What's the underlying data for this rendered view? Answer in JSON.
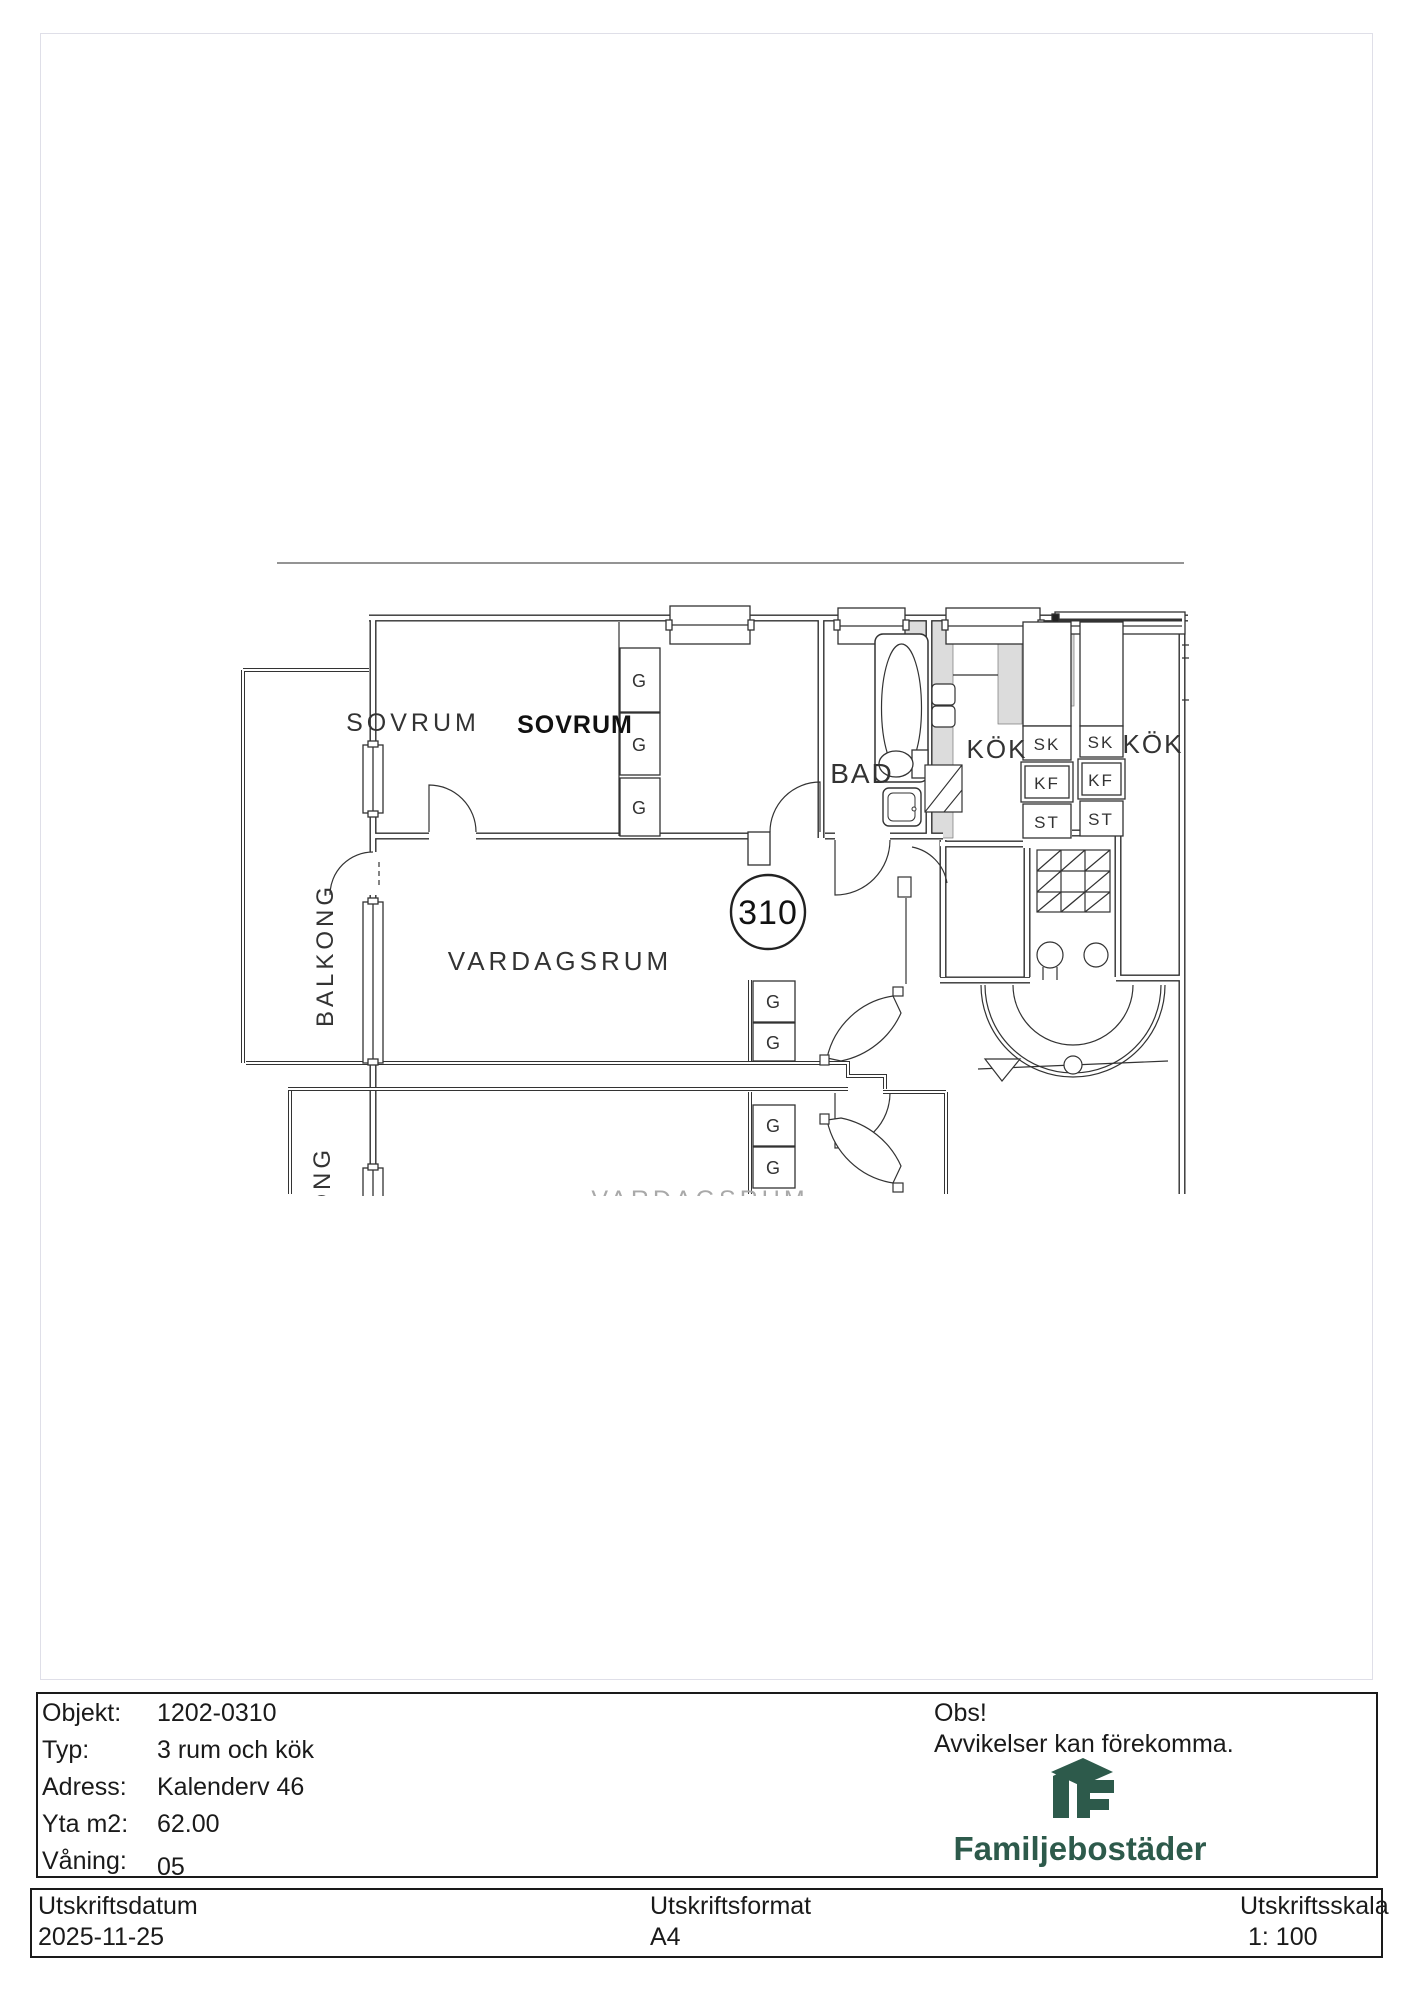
{
  "plan": {
    "apartment_number": "310",
    "labels": {
      "bedroom_left": "SOVRUM",
      "bedroom_right": "SOVRUM",
      "bathroom": "BAD",
      "kitchen_left": "KÖK",
      "kitchen_right": "KÖK",
      "living_room": "VARDAGSRUM",
      "balcony": "BALKONG",
      "balcony_lower": "BALKONG",
      "clipped_lower_room": "VARDAGSRUM",
      "wardrobe": "G",
      "tall_cabinet": "SK",
      "fridge_freezer": "KF",
      "pantry": "ST"
    }
  },
  "info_table": {
    "rows": [
      {
        "label": "Objekt:",
        "value": "1202-0310"
      },
      {
        "label": "Typ:",
        "value": "3 rum och kök"
      },
      {
        "label": "Adress:",
        "value": "Kalenderv 46"
      },
      {
        "label": "Yta m2:",
        "value": "62.00"
      },
      {
        "label": "Våning:",
        "value": "05"
      }
    ]
  },
  "notice": {
    "title": "Obs!",
    "text": "Avvikelser kan förekomma."
  },
  "brand": {
    "name": "Familjebostäder",
    "color": "#2d5a4b"
  },
  "footer": {
    "columns": [
      {
        "label": "Utskriftsdatum",
        "value": "2025-11-25"
      },
      {
        "label": "Utskriftsformat",
        "value": "A4"
      },
      {
        "label": "Utskriftsskala",
        "value": "1: 100"
      }
    ]
  }
}
